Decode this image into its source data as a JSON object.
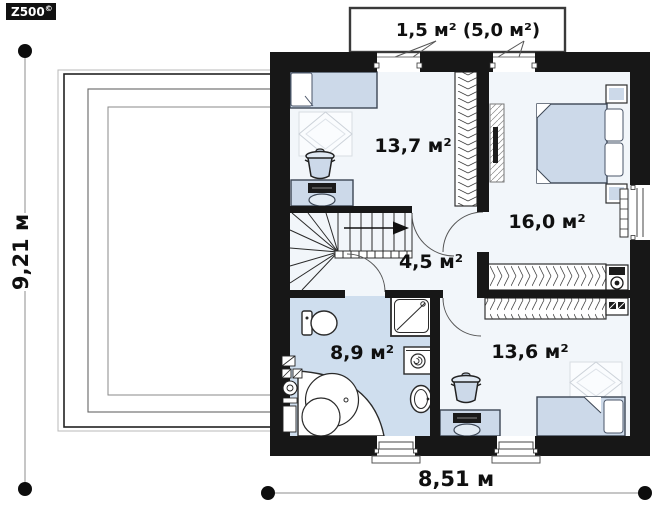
{
  "logo": {
    "brand": "Z500",
    "mark": "©"
  },
  "balcony": {
    "label": "1,5 м² (5,0 м²)"
  },
  "rooms": {
    "bedroom1": {
      "area": "13,7 м²"
    },
    "bedroom2": {
      "area": "16,0 м²"
    },
    "hall": {
      "area": "4,5 м²"
    },
    "bathroom": {
      "area": "8,9 м²"
    },
    "bedroom3": {
      "area": "13,6 м²"
    }
  },
  "dimensions": {
    "width": "8,51 м",
    "height": "9,21 м"
  },
  "colors": {
    "wall": "#171717",
    "room_floor": "#f2f6fa",
    "bathroom_floor": "#cfdeee",
    "furniture_fill": "#ccd9e9",
    "line": "#333333"
  }
}
